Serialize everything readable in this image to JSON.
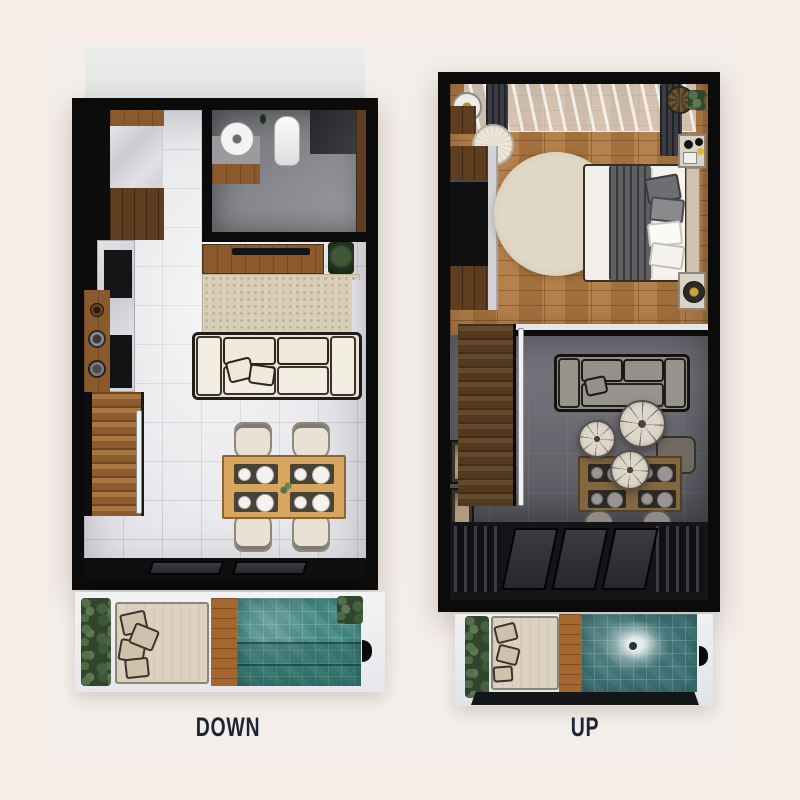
{
  "figure": {
    "type": "floor-plan-pair",
    "plans": {
      "down": {
        "label": "DOWN"
      },
      "up": {
        "label": "UP"
      }
    }
  },
  "palette": {
    "background": "#f8ece8",
    "panel": "#f3eeea",
    "wall_black": "#0b0b0c",
    "tile_floor": "#e8e7eb",
    "wood_floor": "#b07941",
    "stair_wood": "#8a5c2e",
    "rug_beige": "#d8cdb6",
    "sofa_cream": "#e9e3d6",
    "dining_table_wood": "#d8a55e",
    "pool_teal": "#4f908a",
    "pool_deep_teal": "#47787c",
    "plant_green": "#30452c",
    "label_navy": "#1d2433"
  }
}
